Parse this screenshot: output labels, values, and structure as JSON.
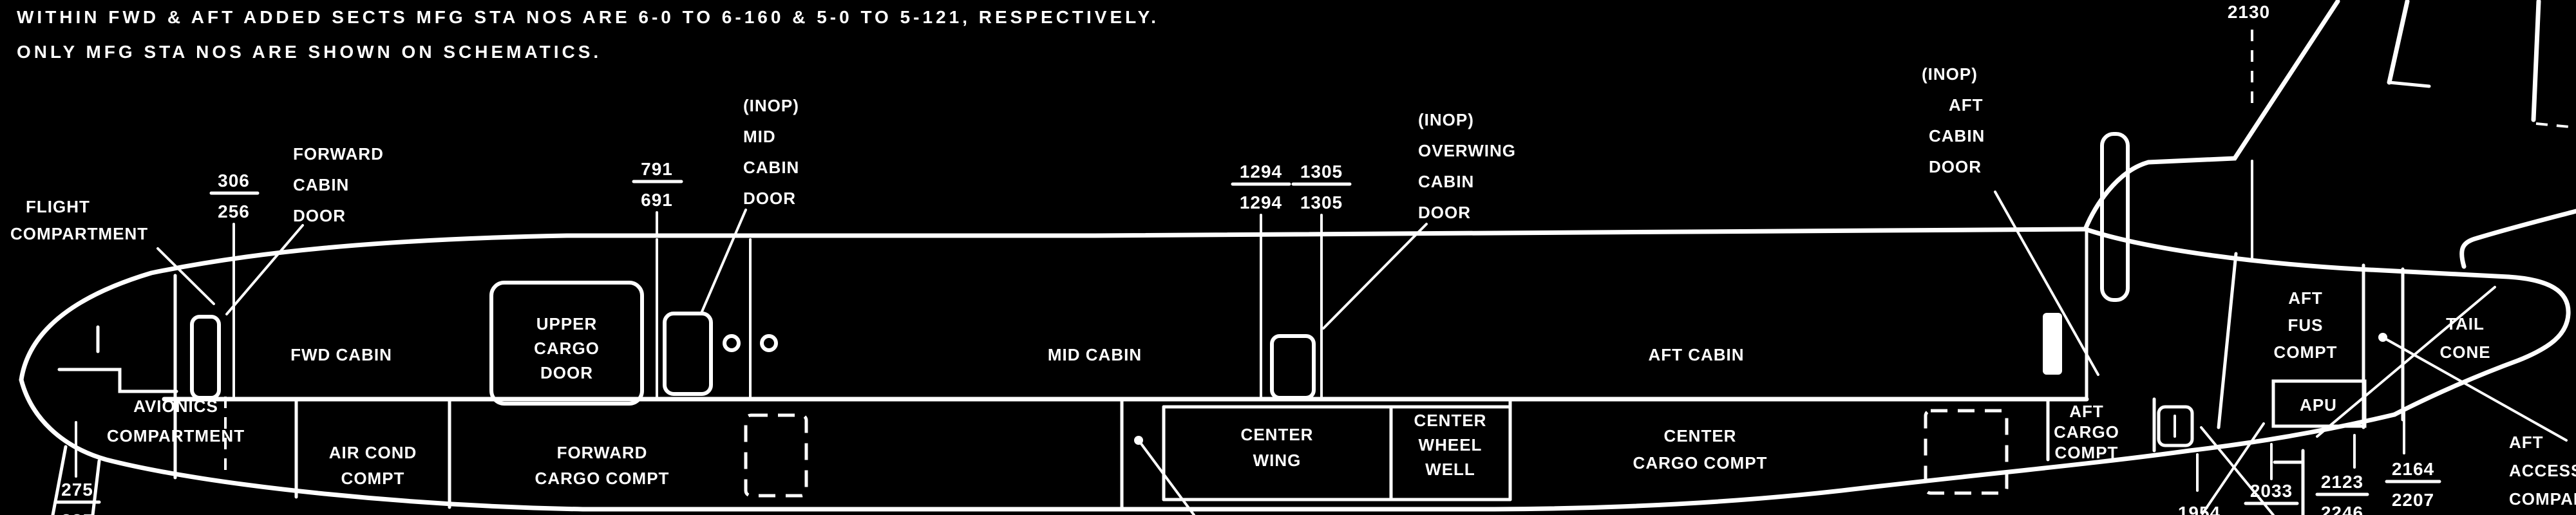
{
  "colors": {
    "background": "#000000",
    "ink": "#ffffff"
  },
  "notes": {
    "line1": "WITHIN FWD & AFT ADDED SECTS MFG STA NOS ARE 6-0 TO 6-160 & 5-0 TO 5-121, RESPECTIVELY.",
    "line2": "ONLY MFG STA NOS ARE SHOWN ON SCHEMATICS."
  },
  "stations": {
    "fwd_door": {
      "num": "306",
      "den": "256"
    },
    "mid_door": {
      "num": "791",
      "den": "691"
    },
    "overwing_fwd": {
      "num": "1294",
      "den": "1294"
    },
    "overwing_aft": {
      "num": "1305",
      "den": "1305"
    },
    "fin": {
      "num": "2130"
    },
    "nose": {
      "num": "275",
      "den": "225"
    },
    "tail_1": {
      "num": "1954"
    },
    "tail_2": {
      "num": "2033",
      "den": "2156"
    },
    "tail_3": {
      "num": "2123",
      "den": "2246"
    },
    "tail_4": {
      "num": "2164",
      "den": "2207"
    }
  },
  "labels": {
    "flight_compartment": [
      "FLIGHT",
      "COMPARTMENT"
    ],
    "forward_cabin_door": [
      "FORWARD",
      "CABIN",
      "DOOR"
    ],
    "mid_cabin_door": [
      "(INOP)",
      "MID",
      "CABIN",
      "DOOR"
    ],
    "overwing_cabin_door": [
      "(INOP)",
      "OVERWING",
      "CABIN",
      "DOOR"
    ],
    "aft_cabin_door": [
      "(INOP)",
      "AFT",
      "CABIN",
      "DOOR"
    ],
    "fwd_cabin": "FWD CABIN",
    "mid_cabin": "MID CABIN",
    "aft_cabin": "AFT CABIN",
    "upper_cargo_door": [
      "UPPER",
      "CARGO",
      "DOOR"
    ],
    "avionics_compartment": [
      "AVIONICS",
      "COMPARTMENT"
    ],
    "air_cond_compt": [
      "AIR COND",
      "COMPT"
    ],
    "forward_cargo_compt": [
      "FORWARD",
      "CARGO COMPT"
    ],
    "center_wing": [
      "CENTER",
      "WING"
    ],
    "center_wheel_well": [
      "CENTER",
      "WHEEL",
      "WELL"
    ],
    "center_cargo_compt": [
      "CENTER",
      "CARGO COMPT"
    ],
    "aft_cargo_compt": [
      "AFT",
      "CARGO",
      "COMPT"
    ],
    "aft_fus_compt": [
      "AFT",
      "FUS",
      "COMPT"
    ],
    "apu": "APU",
    "tail_cone": [
      "TAIL",
      "CONE"
    ],
    "aft_access_compartment": [
      "AFT",
      "ACCESS",
      "COMPARTMENT"
    ]
  }
}
